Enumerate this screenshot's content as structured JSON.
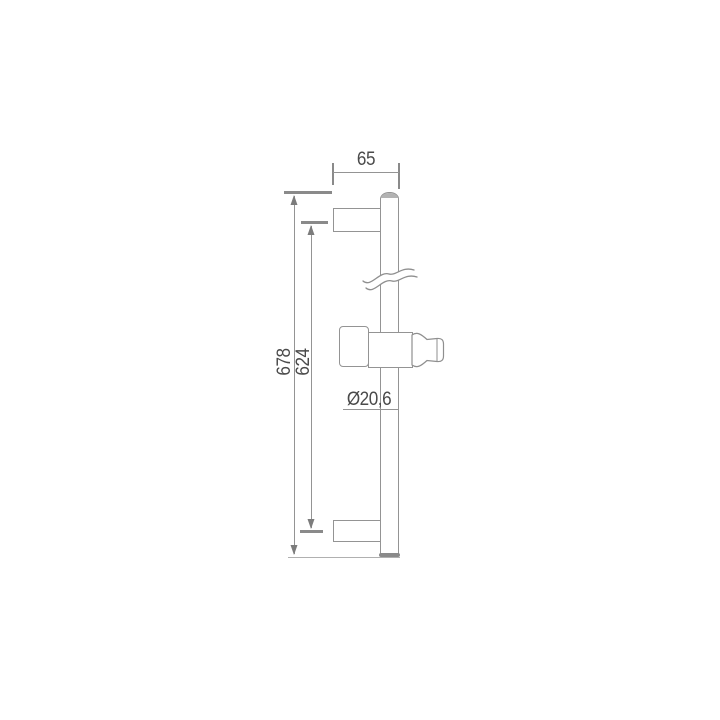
{
  "diagram": {
    "type": "technical-dimension-drawing",
    "subject": "shower slide rail bar with two wall brackets and adjustable handset holder, side view",
    "dimensions": {
      "wall_offset": "65",
      "total_length": "678",
      "bracket_spacing": "624",
      "bar_diameter": "Ø20,6"
    },
    "colors": {
      "background": "#ffffff",
      "line": "#949494",
      "line_dark": "#8a8a8a",
      "line_light": "#b0b0b0",
      "text": "#4a4a4a",
      "cap_fill": "#b3b3b3"
    }
  }
}
